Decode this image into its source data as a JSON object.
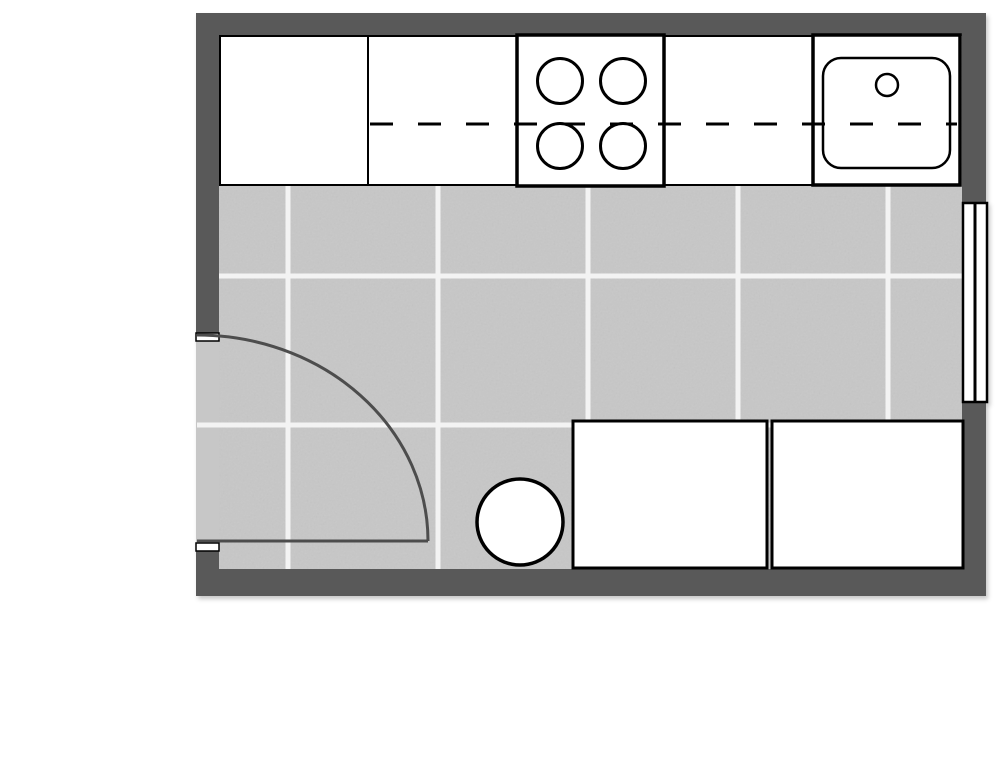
{
  "plan": {
    "title": "kitchen-floor-plan",
    "canvas": {
      "width": 1000,
      "height": 763,
      "background": "#ffffff"
    },
    "palette": {
      "wall": "#595959",
      "floor": "#c7c7c7",
      "grout": "#f3f3f3",
      "fixture_fill": "#ffffff",
      "outline": "#000000",
      "door": "#4d4d4d"
    },
    "room": {
      "outer": {
        "x": 196,
        "y": 13,
        "w": 790,
        "h": 583
      },
      "inner": {
        "x": 219,
        "y": 36,
        "w": 743,
        "h": 533
      }
    },
    "floor_tiles": {
      "grout_width": 5,
      "vertical_lines_x": [
        288,
        438,
        588,
        738,
        888
      ],
      "horizontal_lines": [
        {
          "y": 276,
          "x1": 219
        },
        {
          "y": 425,
          "x1": 197
        }
      ]
    },
    "counter_dash": {
      "y": 124,
      "x1": 370,
      "x2": 957,
      "dash": "23 25",
      "stroke_width": 3
    },
    "cabinets": [
      {
        "name": "tall-cabinet",
        "x": 220,
        "y": 36,
        "w": 148,
        "h": 149,
        "stroke_width": 2
      },
      {
        "name": "counter-cabinet-left",
        "x": 368,
        "y": 36,
        "w": 149,
        "h": 149,
        "stroke_width": 2
      },
      {
        "name": "counter-cabinet-right",
        "x": 664,
        "y": 36,
        "w": 149,
        "h": 149,
        "stroke_width": 2
      },
      {
        "name": "base-cabinet-right-1",
        "x": 573,
        "y": 421,
        "w": 194,
        "h": 147,
        "stroke_width": 3
      },
      {
        "name": "base-cabinet-right-2",
        "x": 772,
        "y": 421,
        "w": 191,
        "h": 147,
        "stroke_width": 3
      }
    ],
    "cooktop": {
      "name": "cooktop",
      "x": 517,
      "y": 35,
      "w": 147,
      "h": 151,
      "stroke_width": 3.5,
      "burners": [
        {
          "cx": 560,
          "cy": 81,
          "r": 22.5
        },
        {
          "cx": 623,
          "cy": 81,
          "r": 22.5
        },
        {
          "cx": 560,
          "cy": 146,
          "r": 22.5
        },
        {
          "cx": 623,
          "cy": 146,
          "r": 22.5
        }
      ],
      "burner_stroke_width": 3
    },
    "sink_unit": {
      "name": "sink-cabinet",
      "x": 813,
      "y": 35,
      "w": 147,
      "h": 150,
      "stroke_width": 3.5,
      "basin": {
        "x": 823,
        "y": 58,
        "w": 127,
        "h": 110,
        "rx": 18,
        "stroke_width": 2.5
      },
      "faucet": {
        "cx": 887,
        "cy": 85,
        "r": 11,
        "stroke_width": 2.5
      }
    },
    "stool": {
      "name": "round-stool",
      "cx": 520,
      "cy": 522,
      "r": 43,
      "stroke_width": 3.5
    },
    "door": {
      "opening": {
        "x": 196,
        "y": 337,
        "w": 23,
        "h": 208
      },
      "jambs": [
        {
          "x": 196,
          "y": 333,
          "w": 23,
          "h": 8
        },
        {
          "x": 196,
          "y": 543,
          "w": 23,
          "h": 8
        }
      ],
      "jamb_stroke_width": 1.5,
      "leaf": {
        "x1": 197,
        "y1": 541,
        "x2": 428,
        "y2": 541
      },
      "swing_path": "M 428 541 A 231 206 0 0 0 197 335",
      "stroke_width": 3
    },
    "window": {
      "x": 963,
      "y": 203,
      "w": 24,
      "h": 199,
      "stroke_width": 2.5,
      "center_line_x": 975,
      "center_line_width": 3
    }
  }
}
